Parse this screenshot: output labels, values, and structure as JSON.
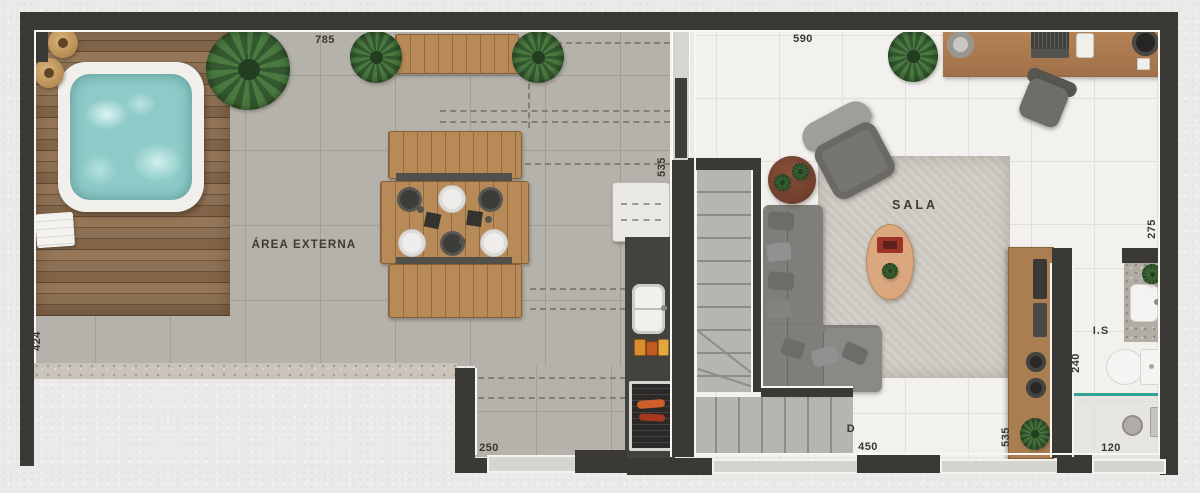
{
  "labels": {
    "area_externa": "ÁREA EXTERNA",
    "sala": "SALA",
    "bathroom": "I.S",
    "stair_down": "D"
  },
  "dimensions": {
    "terrace_top": "785",
    "sala_top": "590",
    "terrace_left": "424",
    "kitchen_wall": "535",
    "terrace_bottom": "250",
    "sala_bottom": "450",
    "sideboard_wall": "535",
    "bathroom_depth": "240",
    "bathroom_width": "120",
    "office_right": "275"
  },
  "palette": {
    "wall": "#3a3936",
    "outdoor_tile": "#b5b1ab",
    "indoor_tile": "#f2f1ee",
    "deck_wood": "#84684c",
    "furniture_wood": "#b78a57",
    "hot_tub_water": "#8ecbc8",
    "plant_green": "#4a7a40",
    "sofa_gray": "#807e7b",
    "rug": "#cbc7bf",
    "counter_dark": "#44423e",
    "shower_glass_teal": "#2ea393",
    "label_text": "#39372f"
  }
}
